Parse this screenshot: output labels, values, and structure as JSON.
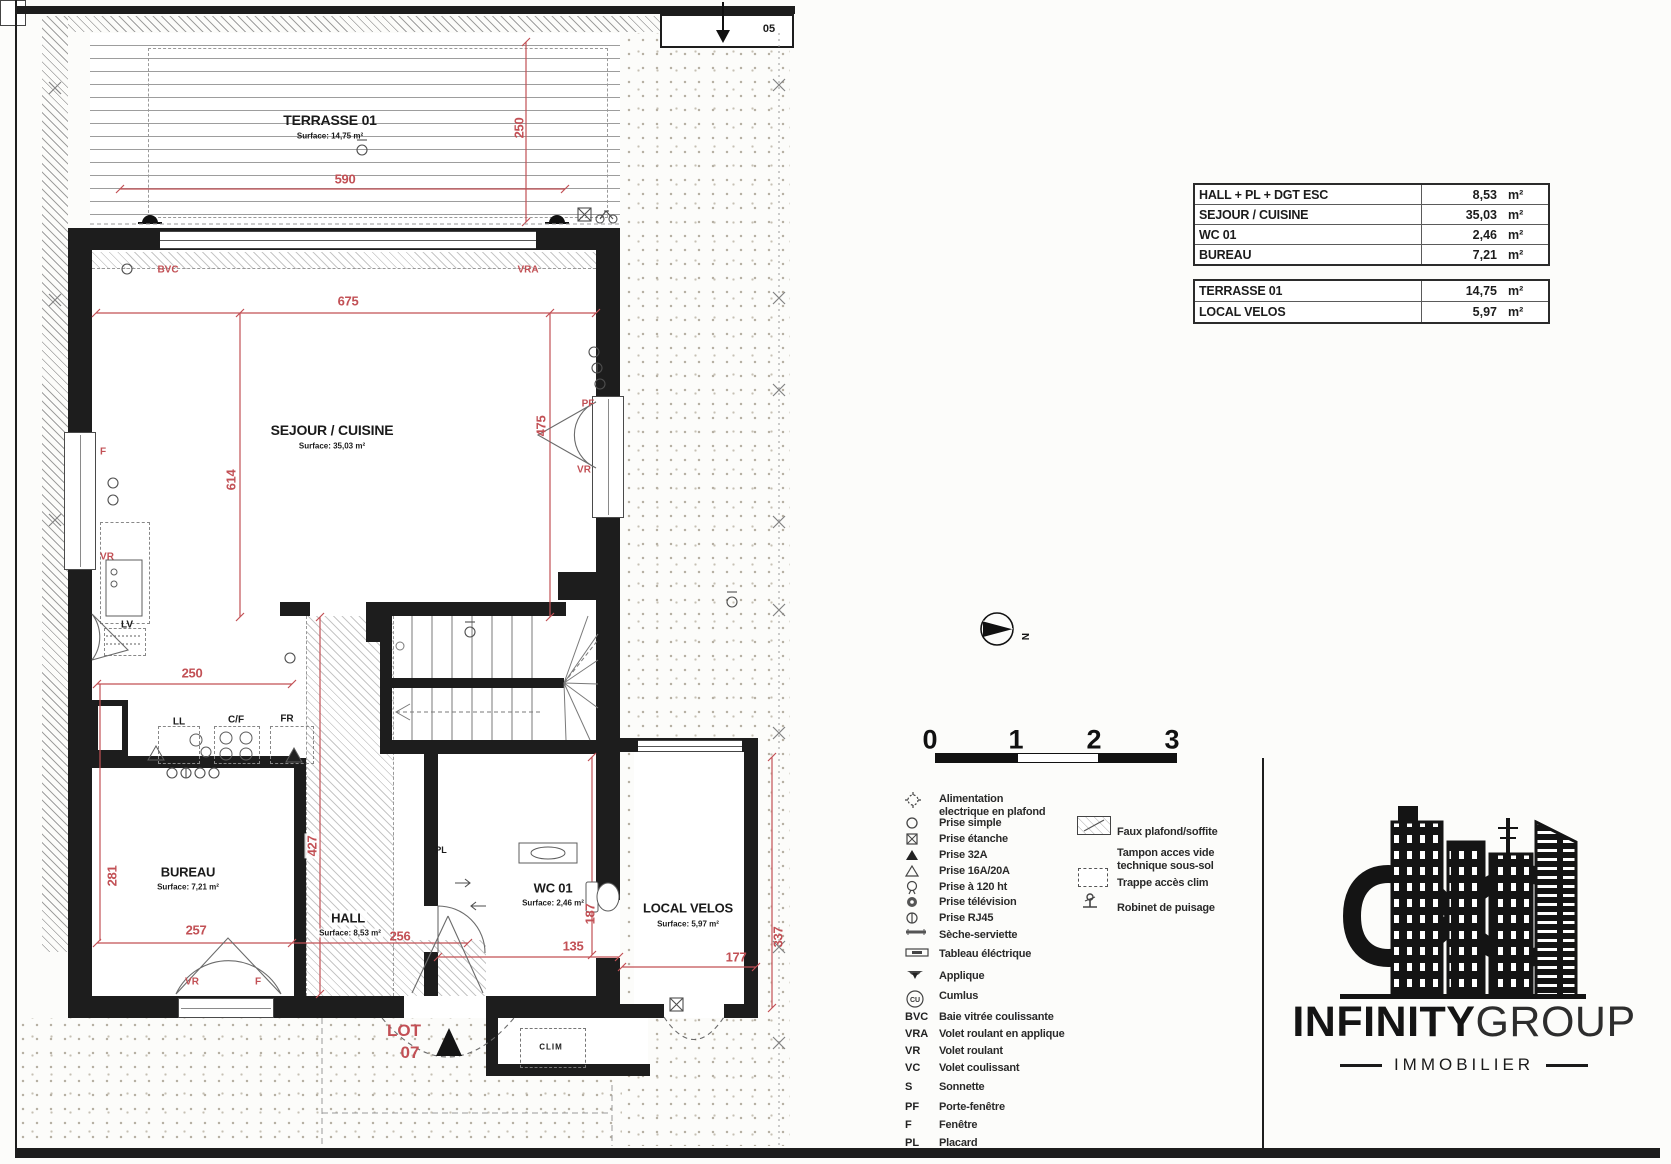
{
  "colors": {
    "dim_red": "#c25055",
    "wall": "#1d1d1d"
  },
  "plan": {
    "marker_05": "05",
    "rooms": {
      "terrasse": {
        "name": "TERRASSE 01",
        "surface": "Surface: 14,75 m²"
      },
      "sejour": {
        "name": "SEJOUR / CUISINE",
        "surface": "Surface: 35,03 m²"
      },
      "bureau": {
        "name": "BUREAU",
        "surface": "Surface: 7,21 m²"
      },
      "hall": {
        "name": "HALL",
        "surface": "Surface: 8,53 m²"
      },
      "wc": {
        "name": "WC 01",
        "surface": "Surface: 2,46 m²"
      },
      "velos": {
        "name": "LOCAL VELOS",
        "surface": "Surface: 5,97 m²"
      }
    },
    "dims": {
      "d590": "590",
      "d250t": "250",
      "d675": "675",
      "d614": "614",
      "d475": "475",
      "d250k": "250",
      "d281": "281",
      "d257": "257",
      "d427": "427",
      "d256": "256",
      "d187": "187",
      "d135": "135",
      "d337": "337",
      "d177": "177"
    },
    "labels": {
      "bvc": "BVC",
      "vra": "VRA",
      "f_left": "F",
      "vr_left": "VR",
      "lv": "LV",
      "ll": "LL",
      "cf": "C/F",
      "fr": "FR",
      "pf": "PF",
      "vr_right": "VR",
      "pl": "PL",
      "vr_bottom": "VR",
      "f_bottom": "F",
      "lot": "LOT",
      "lot_no": "07",
      "clim": "CLIM"
    }
  },
  "tables": {
    "interior": {
      "rows": [
        {
          "label": "HALL + PL + DGT ESC",
          "value": "8,53",
          "unit": "m²"
        },
        {
          "label": "SEJOUR / CUISINE",
          "value": "35,03",
          "unit": "m²"
        },
        {
          "label": "WC 01",
          "value": "2,46",
          "unit": "m²"
        },
        {
          "label": "BUREAU",
          "value": "7,21",
          "unit": "m²"
        }
      ]
    },
    "exterior": {
      "rows": [
        {
          "label": "TERRASSE 01",
          "value": "14,75",
          "unit": "m²"
        },
        {
          "label": "LOCAL VELOS",
          "value": "5,97",
          "unit": "m²"
        }
      ]
    }
  },
  "scalebar": {
    "ticks": [
      "0",
      "1",
      "2",
      "3"
    ]
  },
  "compass": {
    "north": "N"
  },
  "legend": {
    "cu_text": "CU",
    "items": [
      {
        "l1": "Alimentation",
        "l2": "electrique en plafond"
      },
      {
        "l1": "Prise simple"
      },
      {
        "l1": "Prise étanche"
      },
      {
        "l1": "Prise 32A"
      },
      {
        "l1": "Prise 16A/20A"
      },
      {
        "l1": "Prise à 120 ht"
      },
      {
        "l1": "Prise télévision"
      },
      {
        "l1": "Prise RJ45"
      },
      {
        "l1": "Sèche-serviette"
      },
      {
        "l1": "Tableau éléctrique"
      },
      {
        "l1": "Applique"
      },
      {
        "l1": "Cumlus"
      }
    ],
    "abbrevs": [
      {
        "abbr": "BVC",
        "label": "Baie vitrée coulissante"
      },
      {
        "abbr": "VRA",
        "label": "Volet roulant  en applique"
      },
      {
        "abbr": "VR",
        "label": "Volet roulant"
      },
      {
        "abbr": "VC",
        "label": "Volet coulissant"
      },
      {
        "abbr": "S",
        "label": "Sonnette"
      },
      {
        "abbr": "PF",
        "label": "Porte-fenêtre"
      },
      {
        "abbr": "F",
        "label": "Fenêtre"
      },
      {
        "abbr": "PL",
        "label": "Placard"
      }
    ],
    "right": [
      {
        "l1": "Faux plafond/soffite"
      },
      {
        "l1": "Tampon acces vide",
        "l2": "technique sous-sol"
      },
      {
        "l1": "Trappe accès clim"
      },
      {
        "l1": "Robinet de puisage"
      }
    ]
  },
  "logo": {
    "bold": "INFINITY",
    "light": "GROUP",
    "tagline": "IMMOBILIER"
  }
}
